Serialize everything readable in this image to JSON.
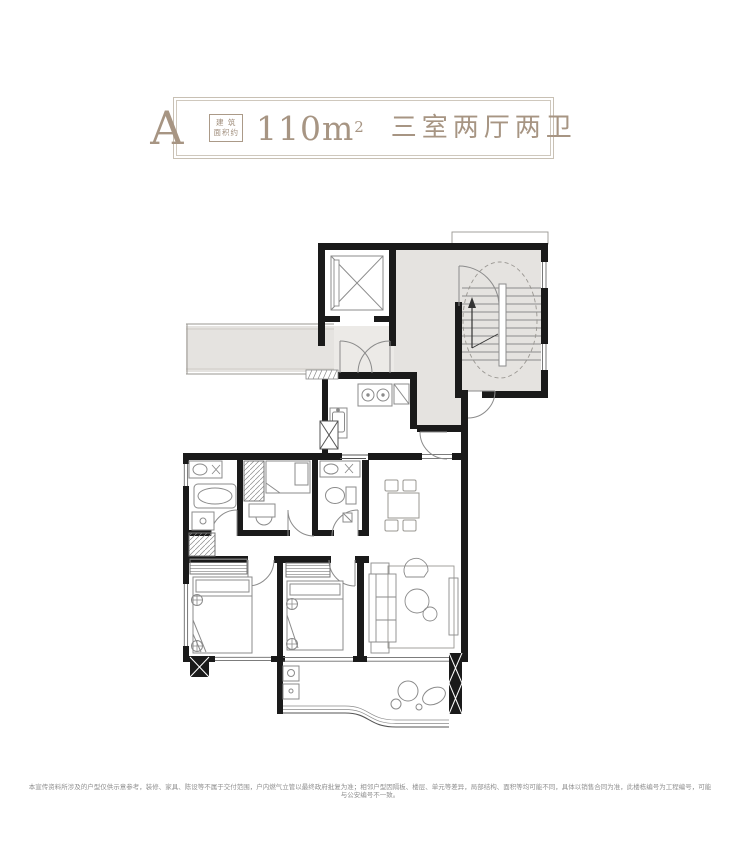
{
  "header": {
    "unit_letter": "A",
    "area_label_line1": "建 筑",
    "area_label_line2": "面积约",
    "area_value": "110m",
    "area_sup": "2",
    "layout_text": "三室两厅两卫",
    "accent_color": "#a79583",
    "border_color": "#c8c0b4"
  },
  "floorplan": {
    "wall_color": "#1a1a1a",
    "public_area_color": "#e5e3e0",
    "furniture_line_color": "#8b8b8b"
  },
  "footer": {
    "disclaimer": "本宣传资料所涉及的户型仅供示意参考，装修、家具、陈设等不属于交付范围，户内燃气立管以最终政府批复为准；相邻户型因隔板、楼层、单元等差异，局部结构、面积等均可能不同，具体以销售合同为准，此楼栋编号为工程编号，可能与公安编号不一致。"
  }
}
